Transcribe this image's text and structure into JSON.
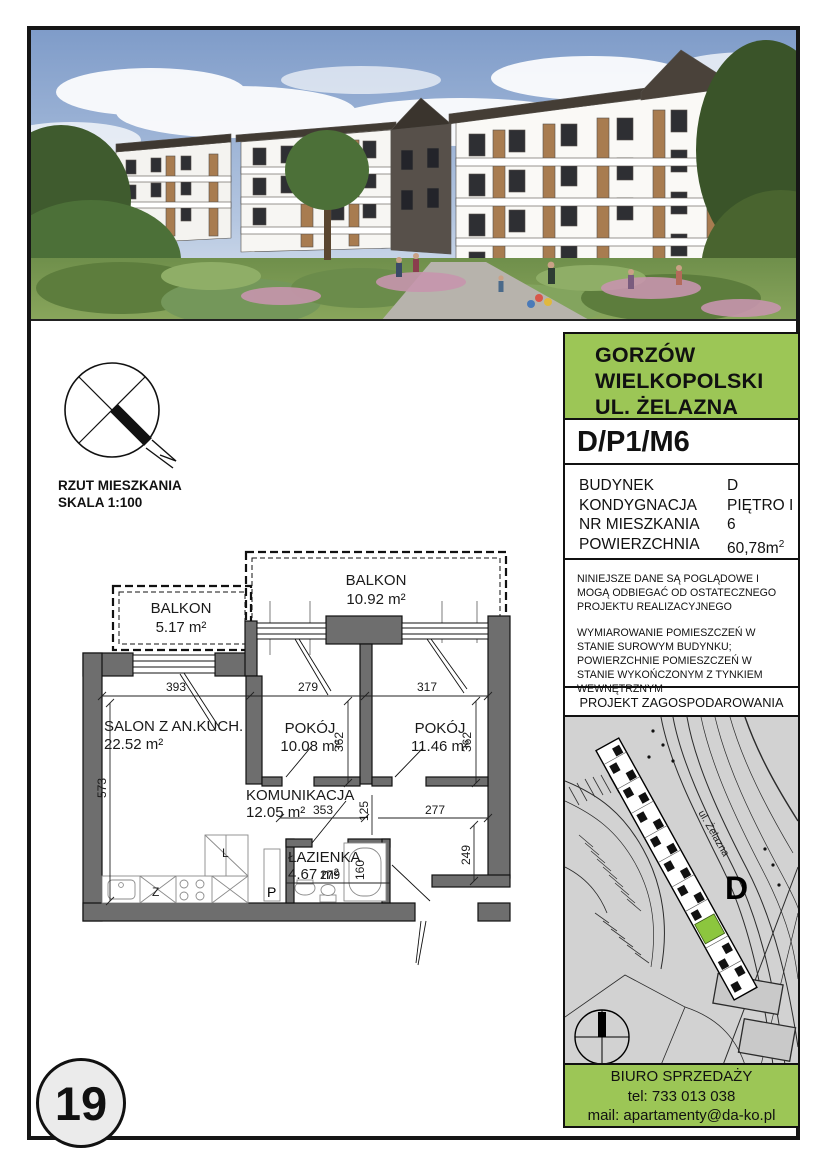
{
  "page": {
    "number": "19"
  },
  "compass": {
    "line1": "RZUT MIESZKANIA",
    "line2": "SKALA 1:100"
  },
  "floor_plan": {
    "rooms": [
      {
        "name": "BALKON",
        "area": "10.92 m²"
      },
      {
        "name": "BALKON",
        "area": "5.17 m²"
      },
      {
        "name": "SALON Z AN.KUCH.",
        "area": "22.52 m²"
      },
      {
        "name": "POKÓJ",
        "area": "10.08 m²"
      },
      {
        "name": "POKÓJ",
        "area": "11.46 m²"
      },
      {
        "name": "KOMUNIKACJA",
        "area": "12.05 m²"
      },
      {
        "name": "ŁAZIENKA",
        "area": "4.67 m²"
      }
    ],
    "dimensions": {
      "salon_width": "393",
      "room1_width": "279",
      "room2_width": "317",
      "room1_depth": "362",
      "room2_depth": "362",
      "salon_depth": "573",
      "hall_width": "353",
      "wall_gap": "125",
      "hall_right": "277",
      "entry_depth": "249",
      "bath_width": "279",
      "bath_depth": "160"
    },
    "fixtures": {
      "l": "L",
      "z": "Z",
      "p": "P"
    }
  },
  "sidebar": {
    "location": {
      "line1": "GORZÓW",
      "line2": "WIELKOPOLSKI",
      "line3": "UL. ŻELAZNA"
    },
    "unit_code": "D/P1/M6",
    "details": [
      {
        "label": "BUDYNEK",
        "value": "D"
      },
      {
        "label": "KONDYGNACJA",
        "value": "PIĘTRO I"
      },
      {
        "label": "NR MIESZKANIA",
        "value": "6"
      },
      {
        "label": "POWIERZCHNIA",
        "value": "60,78m",
        "sup": "2"
      }
    ],
    "disclaimer_1": "NINIEJSZE DANE SĄ POGLĄDOWE I MOGĄ ODBIEGAĆ OD OSTATECZNEGO PROJEKTU REALIZACYJNEGO",
    "disclaimer_2": "WYMIAROWANIE POMIESZCZEŃ W STANIE SUROWYM BUDYNKU; POWIERZCHNIE POMIESZCZEŃ W STANIE WYKOŃCZONYM Z TYNKIEM WEWNĘTRZNYM",
    "map_title": "PROJEKT ZAGOSPODAROWANIA TERENU",
    "map": {
      "street_label": "ul. Żelazna",
      "building_label": "D"
    },
    "footer": {
      "line1": "BIURO SPRZEDAŻY",
      "line2": "tel: 733 013 038",
      "line3": "mail: apartamenty@da-ko.pl"
    }
  },
  "colors": {
    "accent_green": "#9CC656",
    "map_highlight_green": "#8CC63E",
    "wall_gray": "#6E6E6E",
    "map_bg": "#D2D2D2"
  }
}
